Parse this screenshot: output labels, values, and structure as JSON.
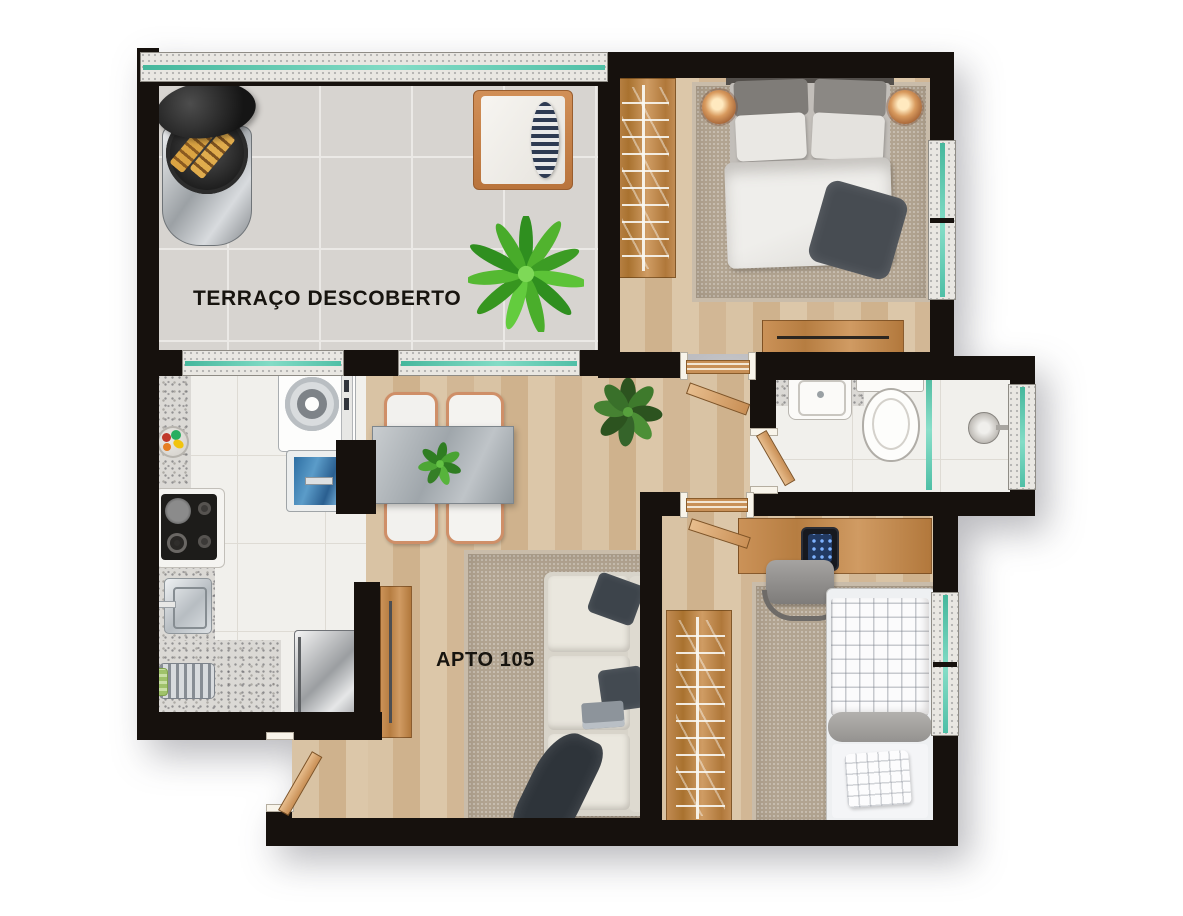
{
  "floor_plan": {
    "unit_label": "APTO 105",
    "terrace_label": "TERRAÇO DESCOBERTO",
    "colors": {
      "wall": "#16110d",
      "glass_accent": "#5cc3aa",
      "wood_floor": "#d6bf9f",
      "terrace_tile": "#d7d4d0",
      "kitchen_tile": "#f1f0ec",
      "granite": "#dbd9d5",
      "rug": "#b2a491",
      "furniture_wood": "#c08a55"
    }
  }
}
